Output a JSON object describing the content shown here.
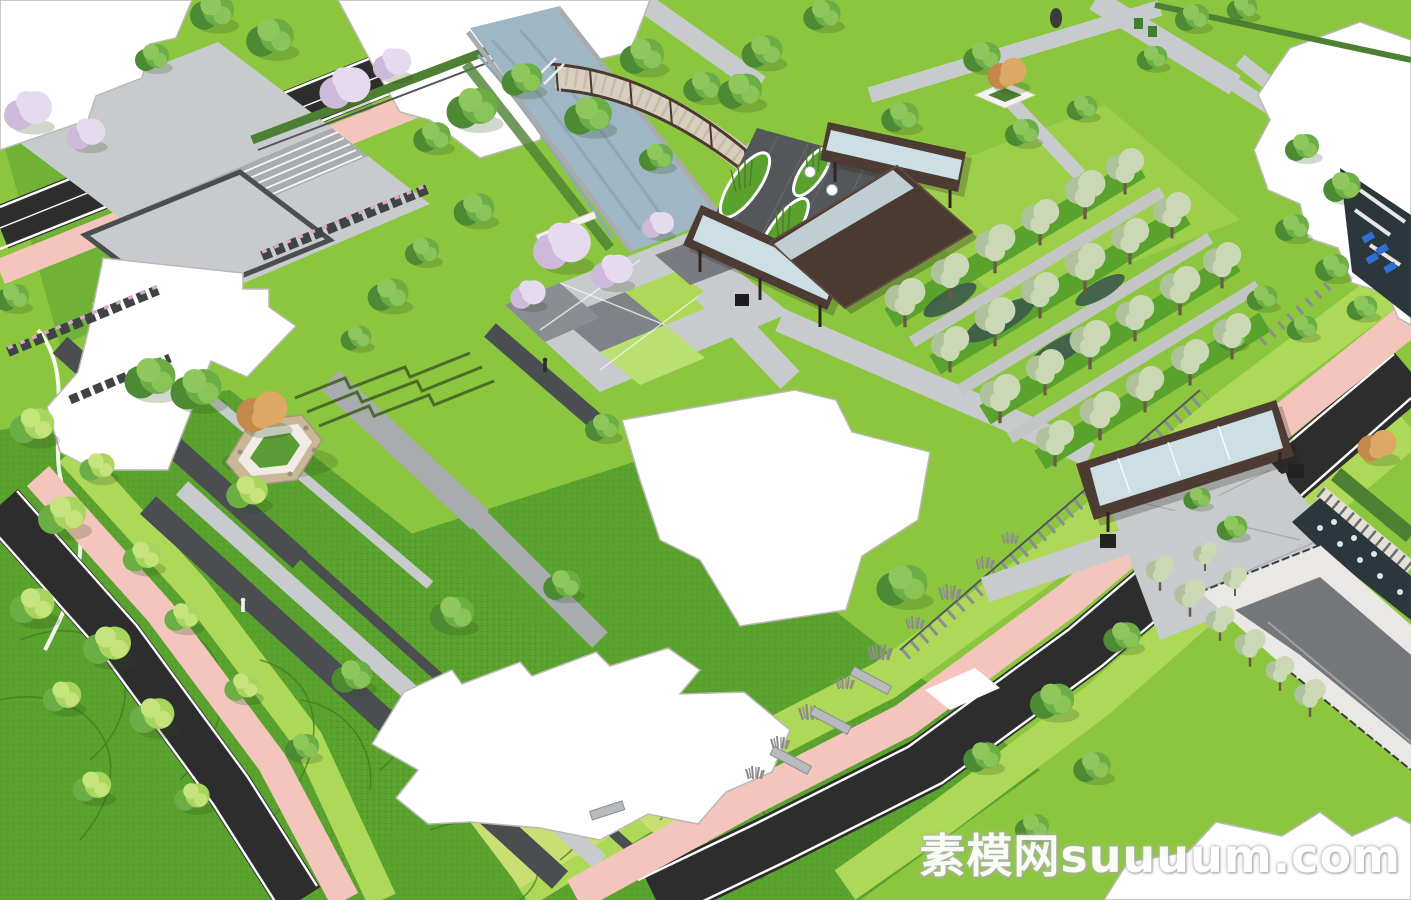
{
  "meta": {
    "title": "Residential community landscape design — aerial 3D model rendering",
    "view": "bird's-eye axonometric render"
  },
  "canvas": {
    "width": 1411,
    "height": 900
  },
  "watermark": {
    "text": "素模网suuuum.com",
    "color": "#FFFFFF"
  },
  "palette": {
    "lawn": "#8CC63F",
    "lawn-dark": "#5AA22E",
    "lawn-lime": "#ADD858",
    "lawn-pale": "#C9DF72",
    "track-pink": "#F3C5BC",
    "road-asphalt": "#2D2D2D",
    "paving-light": "#C8CBCD",
    "paving-mid": "#A8ACAF",
    "paving-dark": "#787C80",
    "path-charcoal": "#4A4E51",
    "courtyard-dark": "#53575A",
    "water": "#9FB6C4",
    "pool-dark": "#2C373D",
    "glass": "#CBDFE5",
    "roof-brown": "#4C3C33",
    "wall-white": "#F1EFE9",
    "planter-tan": "#C9B897",
    "contour-green": "#3E7A22",
    "fountain-dot": "#D9E8EA",
    "lounger-blue": "#2E6FD0",
    "bench-stone": "#B7BBBE",
    "white": "#FFFFFF",
    "tree-green-dark": "#4C8A33",
    "tree-green": "#6BAE46",
    "tree-green-light": "#8FC75C",
    "tree-lime": "#A8D55C",
    "tree-lime-light": "#C6E47E",
    "tree-pale": "#AFC29B",
    "tree-pale-light": "#CBD8B6",
    "blossom": "#CDB9DA",
    "blossom-light": "#E6DBEE",
    "tree-orange": "#C4884A",
    "tree-orange-light": "#DCA864"
  },
  "scene": {
    "type": "aerial-3d-landscape-render",
    "elements": [
      {
        "name": "asphalt-road-top-left",
        "label": "asphalt road with white lane lines"
      },
      {
        "name": "asphalt-road-bottom-left",
        "label": "asphalt road with white lane lines"
      },
      {
        "name": "asphalt-road-right",
        "label": "asphalt road with white lane lines"
      },
      {
        "name": "jogging-track",
        "label": "pink jogging track flanking the roads"
      },
      {
        "name": "water-canal",
        "label": "landscape canal stream"
      },
      {
        "name": "arched-bridge",
        "label": "arched timber footbridge over canal"
      },
      {
        "name": "entrance-courtyard",
        "label": "dark paved entry court with curved planting islands and café tables"
      },
      {
        "name": "entrance-canopies",
        "label": "flat dark-brown canopies with glass skylight strips"
      },
      {
        "name": "entrance-roof",
        "label": "large dark-brown entrance hall roof"
      },
      {
        "name": "tree-bosque",
        "label": "parallel rows of pale-green trees with gravel walks"
      },
      {
        "name": "side-gate-canopy",
        "label": "secondary gate canopy with skylight and slatted white wall"
      },
      {
        "name": "maze-water-garden",
        "label": "dark water garden with white geometric paths and blue loungers"
      },
      {
        "name": "reflecting-pool",
        "label": "dark reflecting pool with fountain jets and timber deck"
      },
      {
        "name": "hexagon-tree-planter",
        "label": "hexagonal seat planter with feature tree"
      },
      {
        "name": "terraced-lawn-steps",
        "label": "stepped lawn terraces"
      },
      {
        "name": "building-footprints",
        "label": "white massing footprints of residential buildings"
      },
      {
        "name": "contour-lawn-mounds",
        "label": "mounded lawn with contour lines"
      },
      {
        "name": "cherry-blossom-trees",
        "label": "purple blossom trees"
      },
      {
        "name": "bench-rows",
        "label": "slatted bench / planter rows with pink flowers"
      },
      {
        "name": "grass-clump-band",
        "label": "ornamental grass clumps with stone benches"
      },
      {
        "name": "garage-ramp",
        "label": "sunken garage ramp with railings (bottom right)"
      },
      {
        "name": "watermark",
        "label": "site watermark text"
      }
    ]
  }
}
